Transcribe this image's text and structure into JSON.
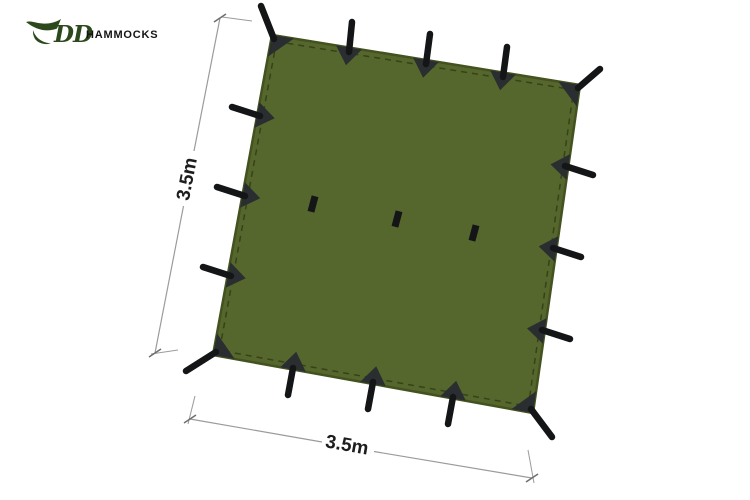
{
  "logo": {
    "brand": "DD",
    "suffix": "HAMMOCKS"
  },
  "dimensions": {
    "height_label": "3.5m",
    "width_label": "3.5m"
  },
  "icons": {
    "logo_swoosh": "hammock-swoosh"
  },
  "colors": {
    "tarp": "#55672d",
    "tarp_edge": "#43521f",
    "stitch": "#2f3a12",
    "patch": "#2a2e30",
    "strap": "#141517",
    "dim_line": "#9b9b9b",
    "dim_tick": "#6e6e6e",
    "dim_text": "#1d1d1d",
    "logo_green": "#2c491c",
    "logo_black": "#141414",
    "background": "#ffffff"
  }
}
